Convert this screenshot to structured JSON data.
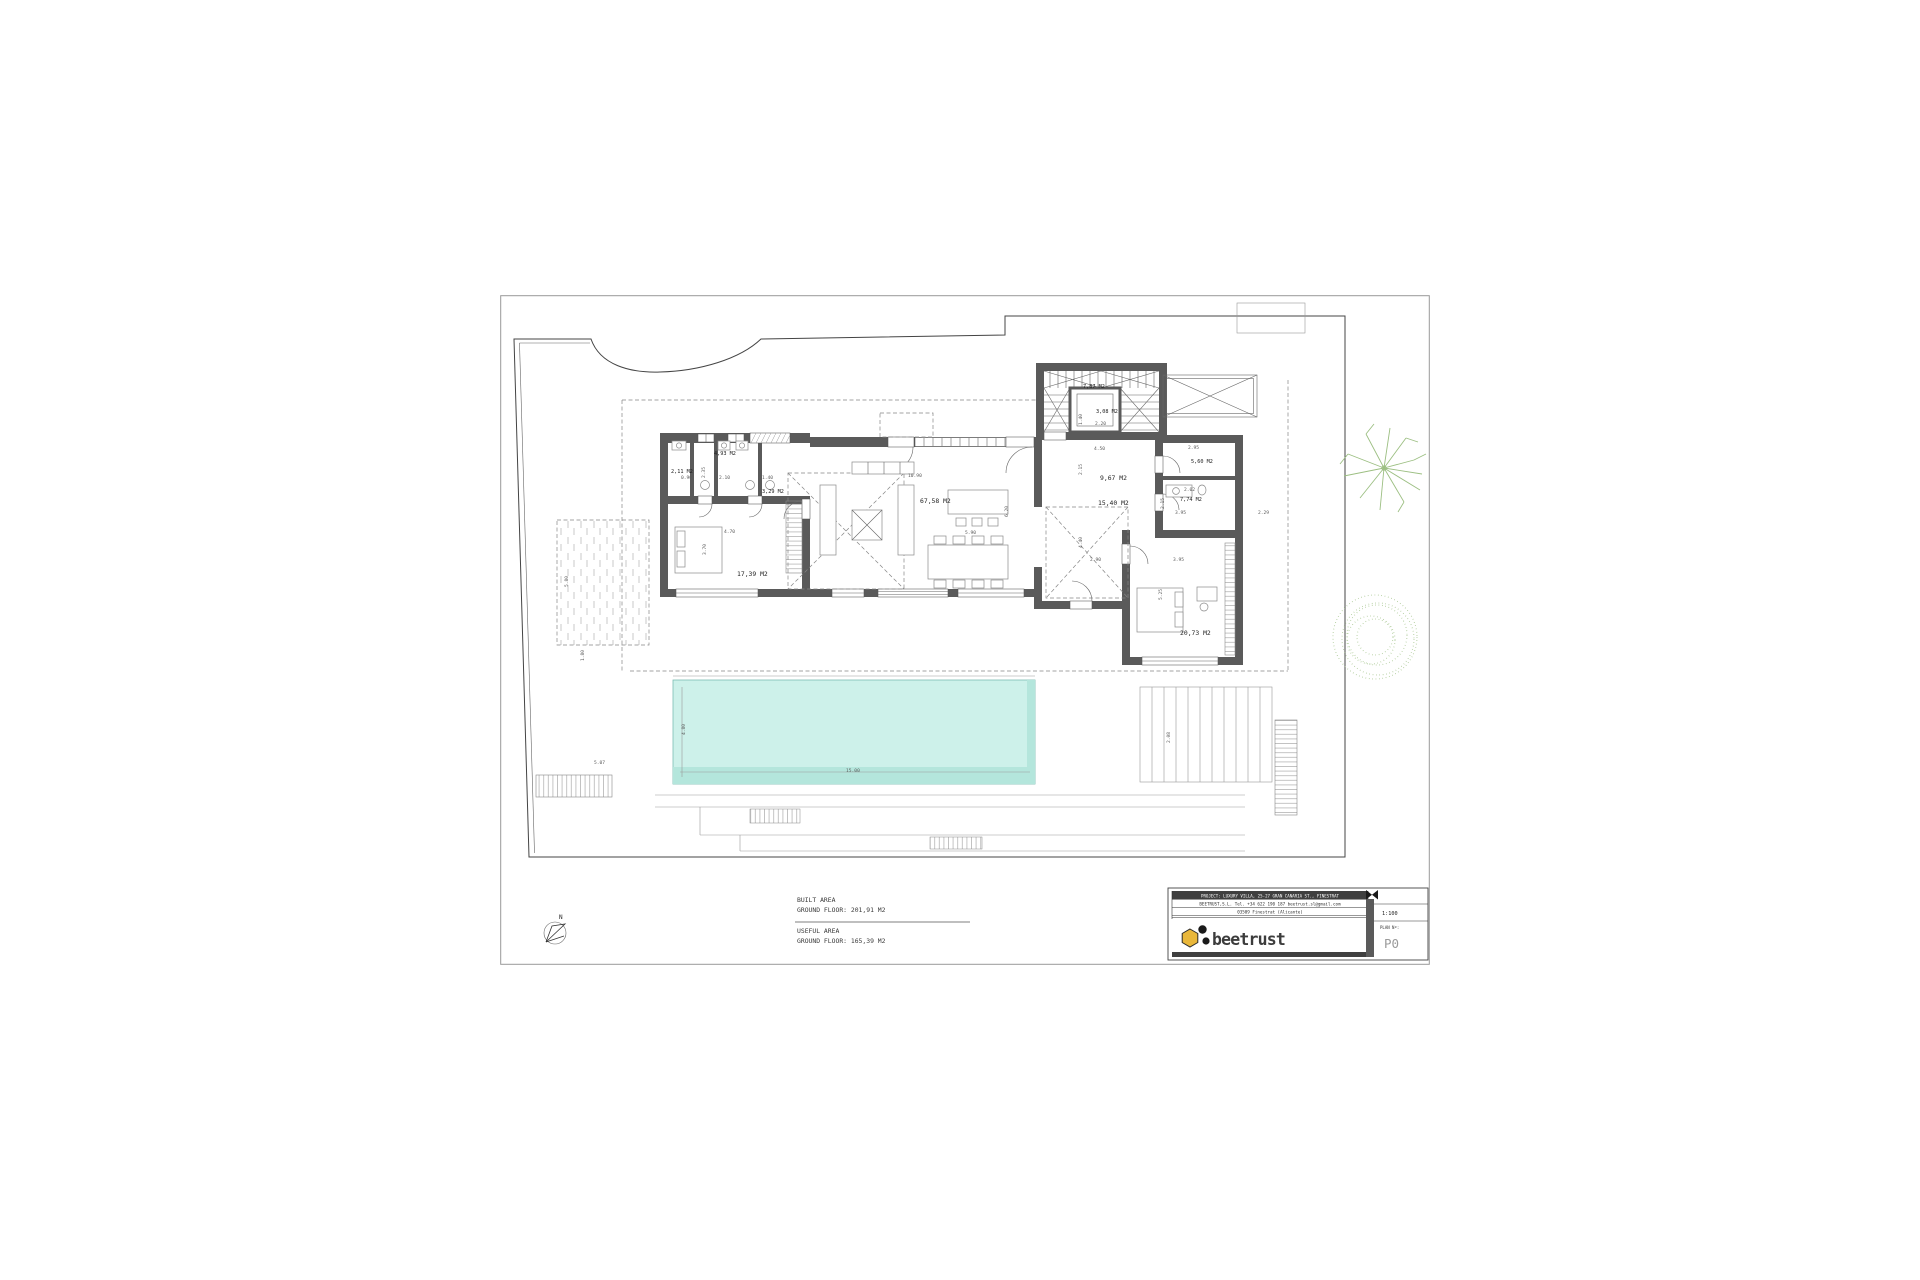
{
  "sheet": {
    "north_label": "N"
  },
  "areas": {
    "built_title": "BUILT AREA",
    "built_value": "GROUND FLOOR: 201,91 M2",
    "useful_title": "USEFUL AREA",
    "useful_value": "GROUND FLOOR: 165,39 M2"
  },
  "title_block": {
    "project_line": "PROJECT: LUXURY VILLA, 25-27 GRAN CANARIA ST., FINESTRAT",
    "company_line": "BEETRUST,S.L.    Tel. +34 622 190 187      beetrust.sl@gmail.com",
    "address_line": "03509 Finestrat (Alicante)",
    "logo_text": "beetrust",
    "scale": "1:100",
    "plan_label": "PLAN Nº:",
    "plan_number": "P0"
  },
  "rooms": [
    {
      "label": "2,11 M2"
    },
    {
      "label": "4,93 M2"
    },
    {
      "label": "3,29 M2"
    },
    {
      "label": "17,39 M2"
    },
    {
      "label": "67,58 M2"
    },
    {
      "label": "7,87 M2"
    },
    {
      "label": "3,08 M2"
    },
    {
      "label": "9,67 M2"
    },
    {
      "label": "5,60 M2"
    },
    {
      "label": "7,74 M2"
    },
    {
      "label": "15,40 M2"
    },
    {
      "label": "20,73 M2"
    }
  ],
  "dims": [
    "0.90",
    "2.35",
    "2.10",
    "1.40",
    "4.70",
    "3.70",
    "5.80",
    "5.00",
    "6.20",
    "10.90",
    "5.90",
    "4.50",
    "2.15",
    "2.95",
    "1.40",
    "2.20",
    "3.95",
    "2.29",
    "4.40",
    "2.90",
    "3.95",
    "5.25",
    "2.02",
    "2.15",
    "1.80",
    "5.07",
    "4.80",
    "15.00",
    "2.08"
  ],
  "colors": {
    "pool": "#cdf1ea",
    "pool_deep": "#b4e6dc",
    "wall": "#5a5a5a",
    "tree": "#9cbf82",
    "brand_gold": "#e9b73a"
  }
}
